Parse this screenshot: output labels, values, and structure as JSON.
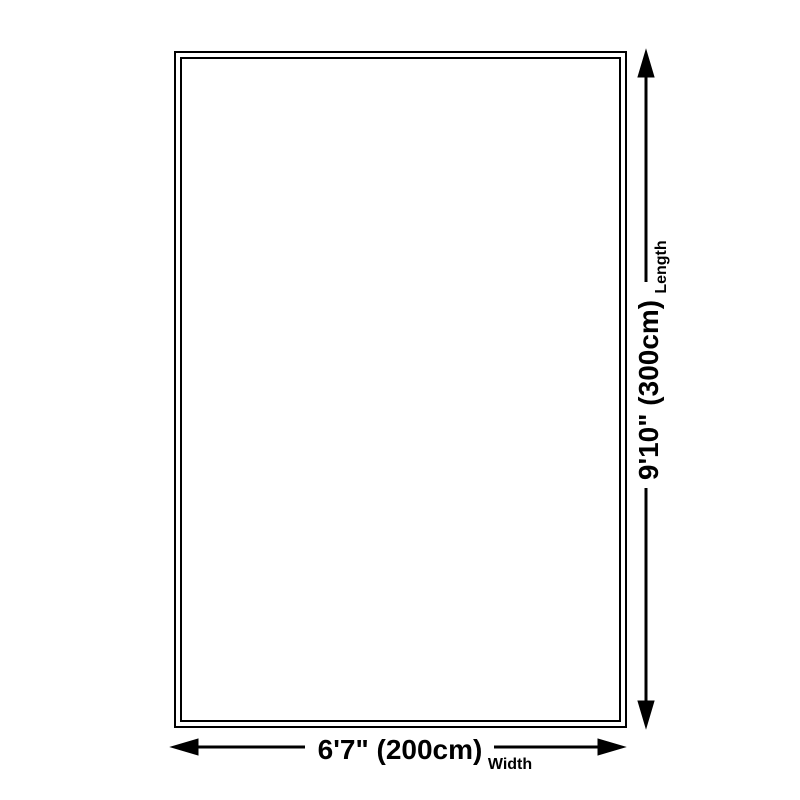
{
  "diagram": {
    "dimensions": {
      "length": {
        "value": "9'10\" (300cm)",
        "label": "Length"
      },
      "width": {
        "value": "6'7\" (200cm)",
        "label": "Width"
      }
    },
    "colors": {
      "background": "#ffffff",
      "line": "#000000",
      "text": "#000000"
    },
    "icons": {
      "arrow_up": "arrow-up-icon",
      "arrow_down": "arrow-down-icon",
      "arrow_left": "arrow-left-icon",
      "arrow_right": "arrow-right-icon"
    }
  }
}
